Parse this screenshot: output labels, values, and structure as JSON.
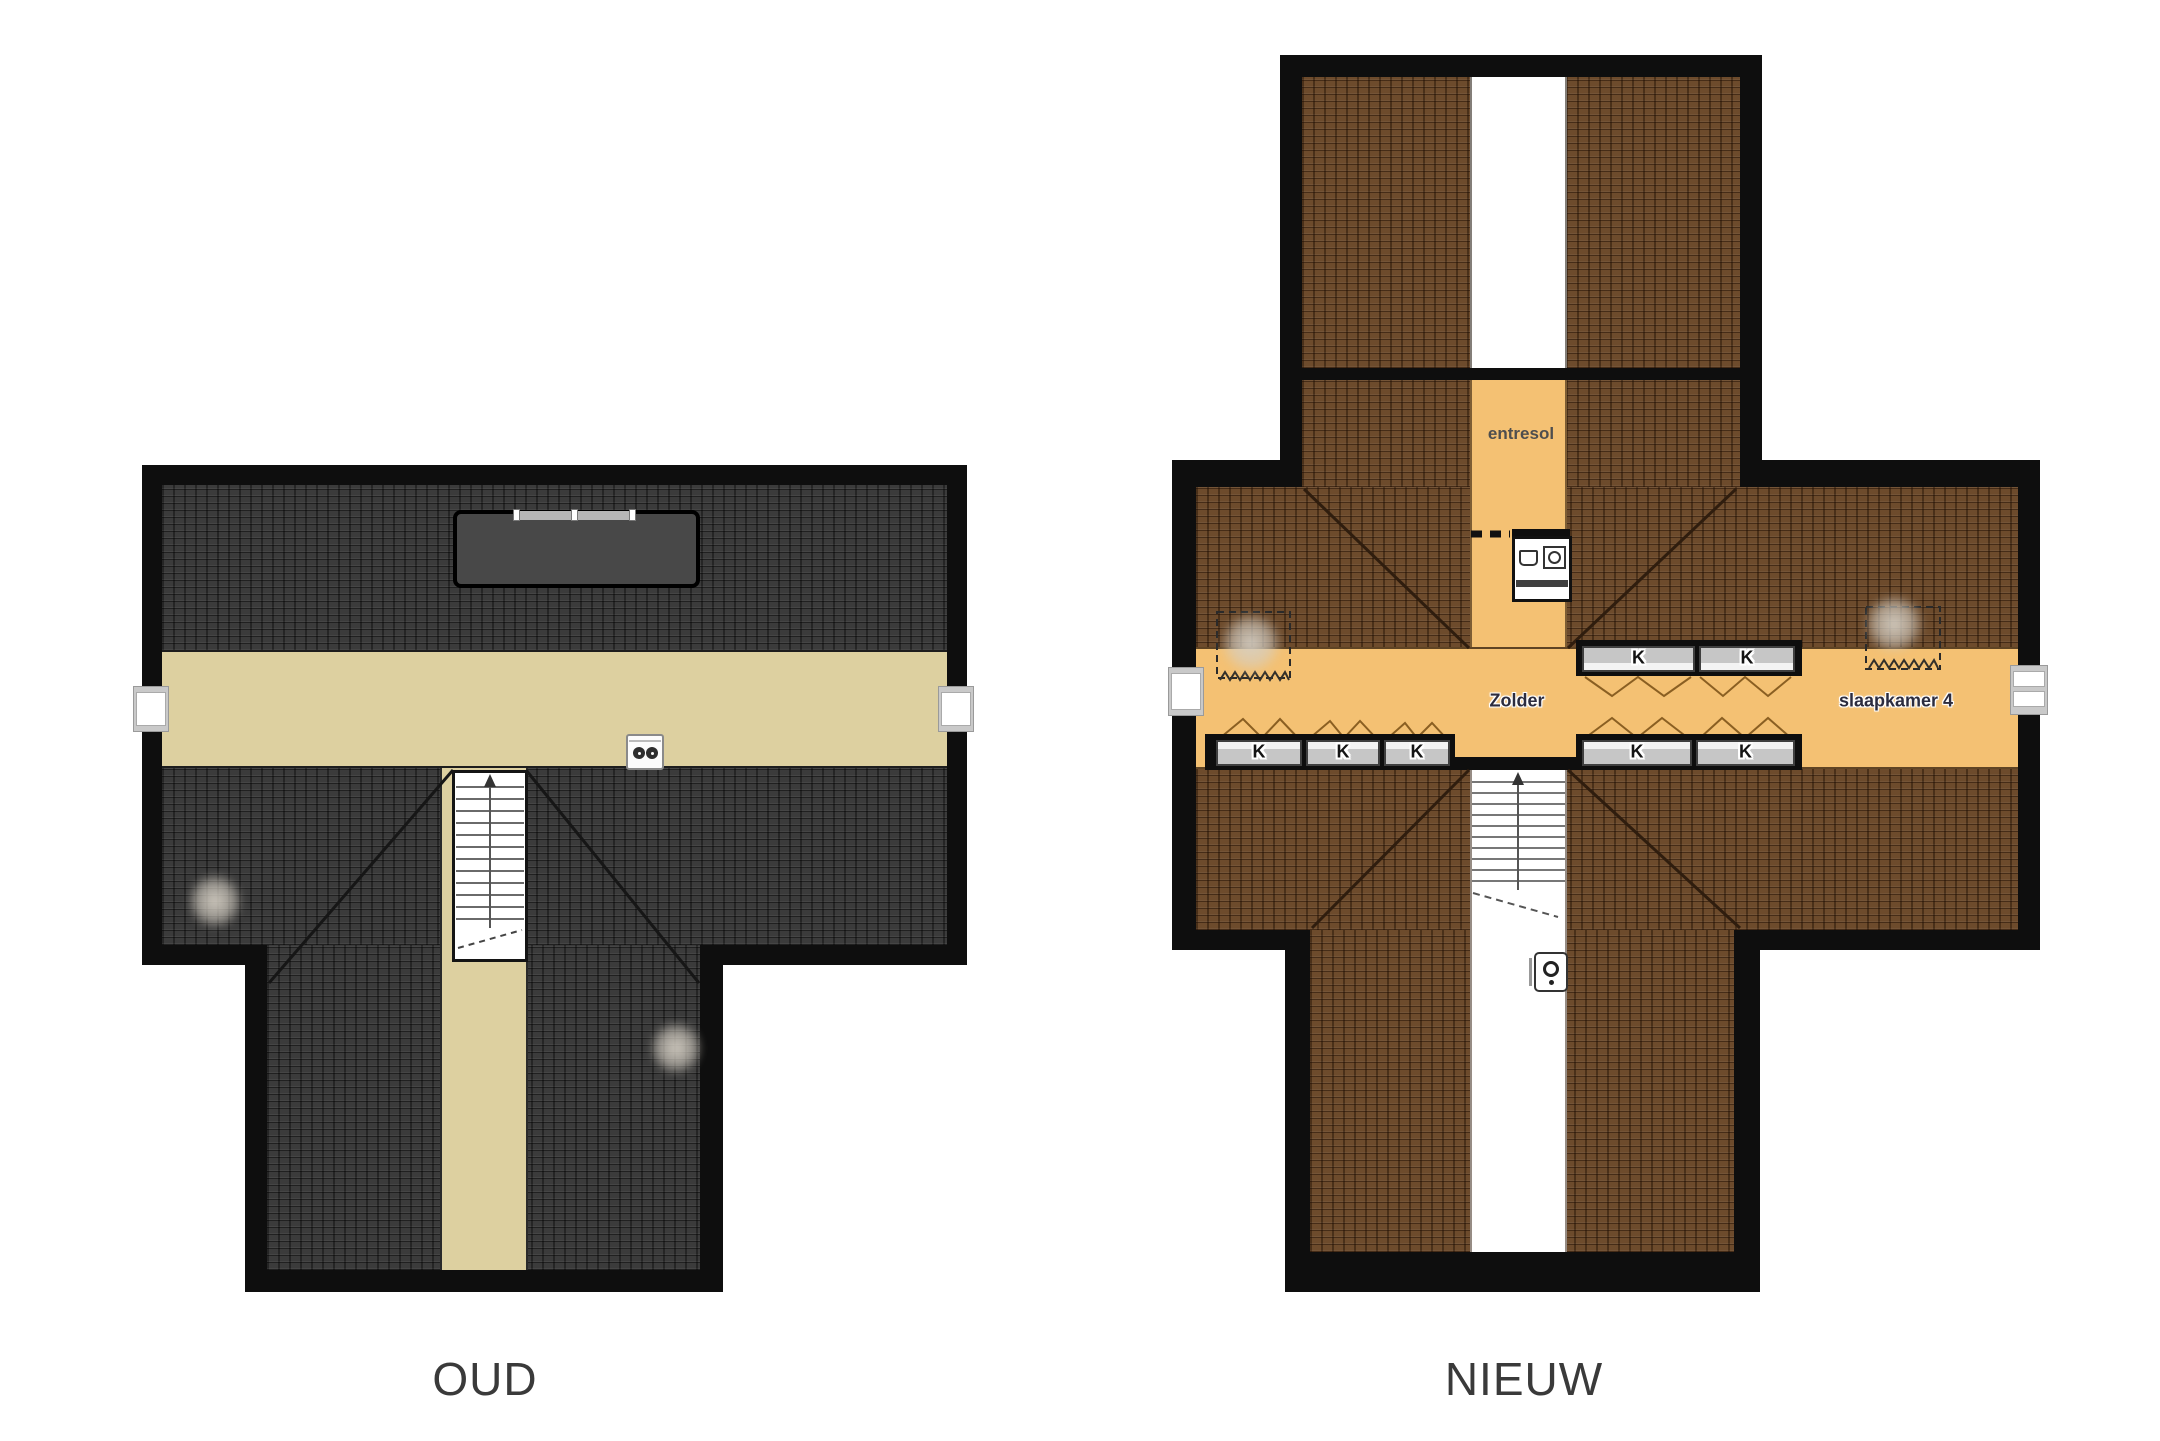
{
  "page": {
    "background": "#ffffff",
    "type": "floorplan-comparison"
  },
  "oud": {
    "caption": "OUD",
    "colors": {
      "roof": "#3b3b3b",
      "floor": "#ddd0a0",
      "dormer": "#484848",
      "wall": "#0e0e0e"
    },
    "icons": {
      "vent_unit": "double-socket-vent-icon"
    },
    "features": [
      "dormer-skylight",
      "stairs",
      "corridor",
      "left-window",
      "right-window"
    ]
  },
  "nieuw": {
    "caption": "NIEUW",
    "colors": {
      "roof": "#6d4b2c",
      "floor": "#f4c173",
      "wall": "#0e0e0e"
    },
    "rooms": {
      "entresol": "entresol",
      "zolder": "Zolder",
      "slaapkamer": "slaapkamer 4"
    },
    "closets": [
      {
        "label": "K"
      },
      {
        "label": "K"
      },
      {
        "label": "K"
      },
      {
        "label": "K"
      },
      {
        "label": "K"
      },
      {
        "label": "K"
      },
      {
        "label": "K"
      }
    ],
    "icons": {
      "laundry": "laundry-basket-icon",
      "washer": "washing-machine-icon",
      "boiler": "wall-boiler-icon"
    },
    "features": [
      "void-strip",
      "stairs",
      "storage-areas-dashed",
      "left-window",
      "right-window-double"
    ]
  }
}
